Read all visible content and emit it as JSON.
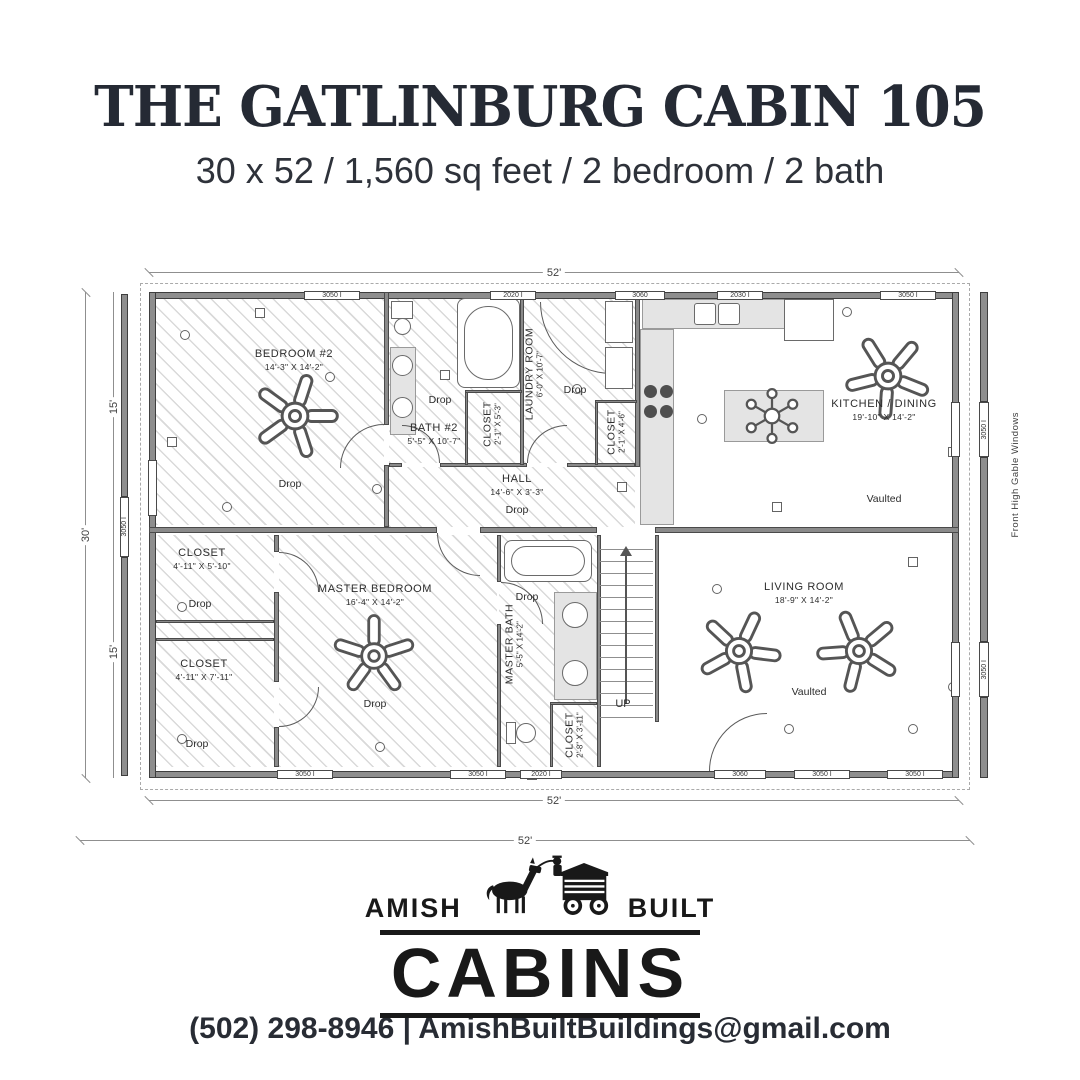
{
  "header": {
    "title": "THE GATLINBURG CABIN 105",
    "subtitle": "30 x 52 / 1,560 sq feet / 2 bedroom / 2 bath"
  },
  "plan": {
    "dimensions": {
      "top_width": "52'",
      "bottom_width": "52'",
      "bottom_width2": "52'",
      "left_total": "30'",
      "left_upper": "15'",
      "left_lower": "15'"
    },
    "side_note": "Front High Gable Windows",
    "stairs_label": "UP",
    "rooms": {
      "bedroom2": {
        "name": "BEDROOM #2",
        "dims": "14'-3\" X 14'-2\"",
        "note": "Drop"
      },
      "bath2": {
        "name": "BATH #2",
        "dims": "5'-5\" X 10'-7\"",
        "note": "Drop"
      },
      "closet_bath": {
        "name": "CLOSET",
        "dims": "2'-1\" X 5'-3\""
      },
      "laundry": {
        "name": "LAUNDRY ROOM",
        "dims": "6'-0\" X 10'-7\"",
        "note": "Drop"
      },
      "closet_laundry": {
        "name": "CLOSET",
        "dims": "2'-1\" X 4'-6\""
      },
      "hall": {
        "name": "HALL",
        "dims": "14'-6\" X 3'-3\"",
        "note": "Drop"
      },
      "kitchen": {
        "name": "KITCHEN / DINING",
        "dims": "19'-10\" X 14'-2\"",
        "note": "Vaulted"
      },
      "master_bedroom": {
        "name": "MASTER BEDROOM",
        "dims": "16'-4\" X 14'-2\"",
        "note": "Drop"
      },
      "closet_upper": {
        "name": "CLOSET",
        "dims": "4'-11\" X 5'-10\"",
        "note": "Drop"
      },
      "closet_lower": {
        "name": "CLOSET",
        "dims": "4'-11\" X 7'-11\"",
        "note": "Drop"
      },
      "master_bath": {
        "name": "MASTER BATH",
        "dims": "5'-5\" X 14'-2\"",
        "note": "Drop"
      },
      "closet_mbath": {
        "name": "CLOSET",
        "dims": "2'-8\" X 3'-11\""
      },
      "living": {
        "name": "LIVING ROOM",
        "dims": "18'-9\" X 14'-2\"",
        "note": "Vaulted"
      }
    },
    "windows_top": [
      {
        "label": "3050 I"
      },
      {
        "label": "2020 I"
      },
      {
        "label": "3060"
      },
      {
        "label": "2030 I"
      },
      {
        "label": "3050 I"
      }
    ],
    "windows_bottom": [
      {
        "label": "3050 I"
      },
      {
        "label": "3050 I"
      },
      {
        "label": "2020 I"
      },
      {
        "label": "3060"
      },
      {
        "label": "3050 I"
      },
      {
        "label": "3050 I"
      }
    ],
    "windows_left": [
      {
        "label": "3050 I"
      }
    ],
    "windows_right": [
      {
        "label": "3050 I"
      },
      {
        "label": "3050 I"
      }
    ]
  },
  "logo": {
    "word_left": "AMISH",
    "word_right": "BUILT",
    "word_main": "CABINS"
  },
  "footer": {
    "contact": "(502) 298-8946 | AmishBuiltBuildings@gmail.com"
  }
}
